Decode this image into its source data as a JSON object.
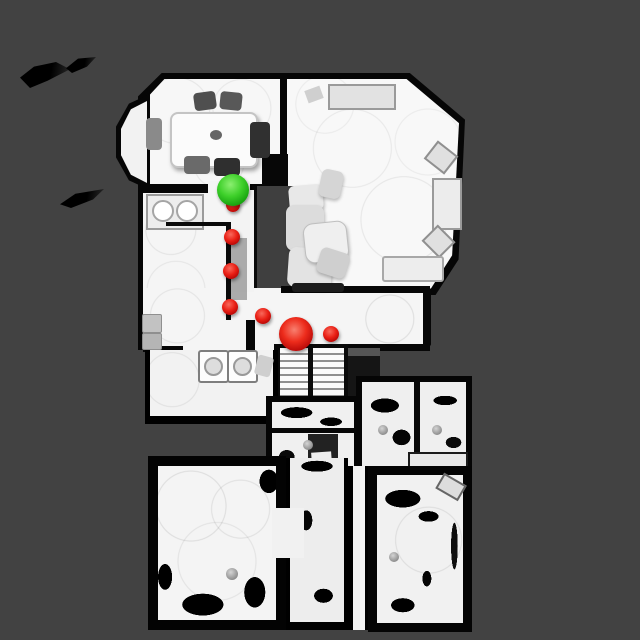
{
  "scene": {
    "title": "top-down-house-scan-view",
    "background_color": "#424242",
    "canvas": {
      "width": 640,
      "height": 640
    }
  },
  "markers": {
    "start": {
      "label": "start-sphere",
      "x": 233,
      "y": 190,
      "r": 16,
      "color_center": "#55e34f",
      "color_edge": "#0a6d06"
    },
    "goal": {
      "label": "goal-sphere",
      "x": 296,
      "y": 334,
      "r": 17,
      "color_center": "#ed2c1c",
      "color_edge": "#830000"
    },
    "waypoint_color_center": "#ea2015",
    "waypoint_color_edge": "#860101",
    "waypoints": [
      {
        "x": 233,
        "y": 205,
        "r": 7
      },
      {
        "x": 232,
        "y": 237,
        "r": 8
      },
      {
        "x": 231,
        "y": 271,
        "r": 8
      },
      {
        "x": 230,
        "y": 307,
        "r": 8
      },
      {
        "x": 263,
        "y": 316,
        "r": 8
      },
      {
        "x": 331,
        "y": 334,
        "r": 8
      }
    ],
    "knobs": [
      {
        "x": 308,
        "y": 445,
        "r": 5
      },
      {
        "x": 383,
        "y": 430,
        "r": 5
      },
      {
        "x": 437,
        "y": 430,
        "r": 5
      },
      {
        "x": 232,
        "y": 574,
        "r": 6
      },
      {
        "x": 394,
        "y": 557,
        "r": 5
      }
    ]
  }
}
